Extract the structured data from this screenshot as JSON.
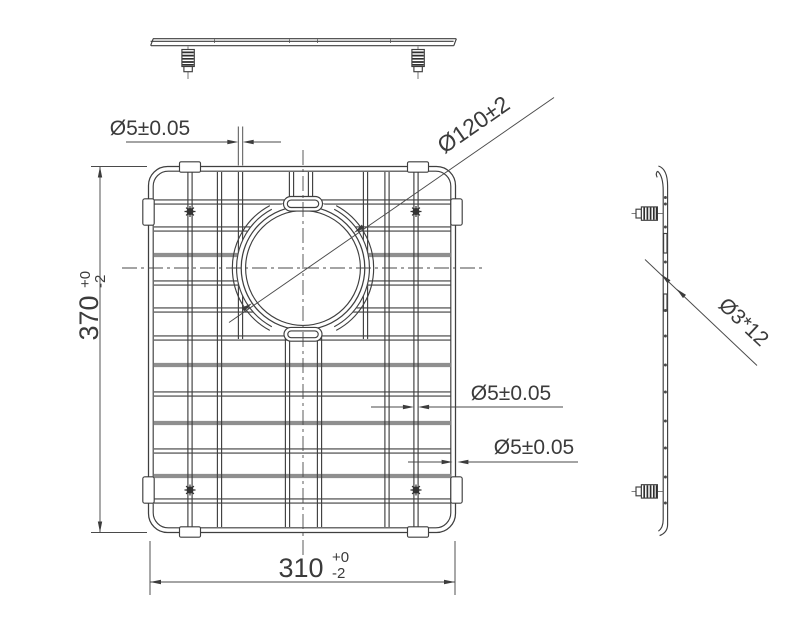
{
  "drawing_labels": {
    "wire_dia_top": "Ø5±0.05",
    "hole_dia": "Ø120±2",
    "wire_dia_mid": "Ø5±0.05",
    "wire_dia_low": "Ø5±0.05",
    "height_dim": {
      "value": "370",
      "tol_plus": "+0",
      "tol_minus": "-2"
    },
    "width_dim": {
      "value": "310",
      "tol_plus": "+0",
      "tol_minus": "-2"
    },
    "side_wire_dia": "Ø3*12"
  },
  "colors": {
    "background": "#ffffff",
    "drawing_line": "#3f3f3f",
    "shaded_wire": "#8f8f8f",
    "dimension_line": "#4a4a4a",
    "text": "#3b3b3b"
  }
}
